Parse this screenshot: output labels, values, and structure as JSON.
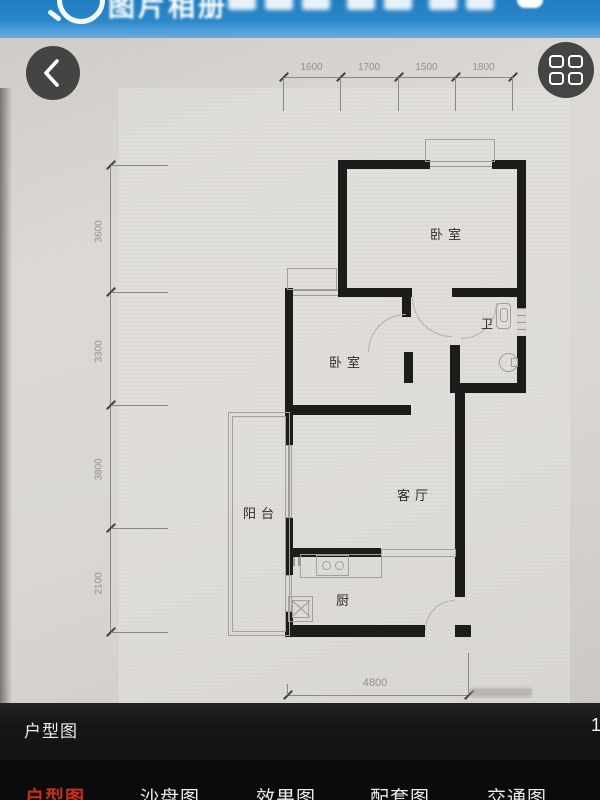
{
  "banner": {
    "partial_text": "图片相册"
  },
  "icons": {
    "search": "magnifier",
    "back": "chevron-left",
    "menu": "grid-2x2"
  },
  "floorplan": {
    "rooms": [
      {
        "label": "卧室"
      },
      {
        "label": "卫"
      },
      {
        "label": "卧室"
      },
      {
        "label": "客厅"
      },
      {
        "label": "阳台"
      },
      {
        "label": "厨"
      }
    ],
    "dimensions": {
      "top": [
        "1600",
        "1700",
        "1500",
        "1800"
      ],
      "left": [
        "3600",
        "3300",
        "3800",
        "2100"
      ],
      "bottom": "4800"
    }
  },
  "info_bar": {
    "title": "户型图",
    "page_indicator": "1/"
  },
  "tab_bar": {
    "active_color": "#c5311d",
    "tabs": [
      {
        "label": "户型图"
      },
      {
        "label": "沙盘图"
      },
      {
        "label": "效果图"
      },
      {
        "label": "配套图"
      },
      {
        "label": "交通图"
      }
    ]
  }
}
